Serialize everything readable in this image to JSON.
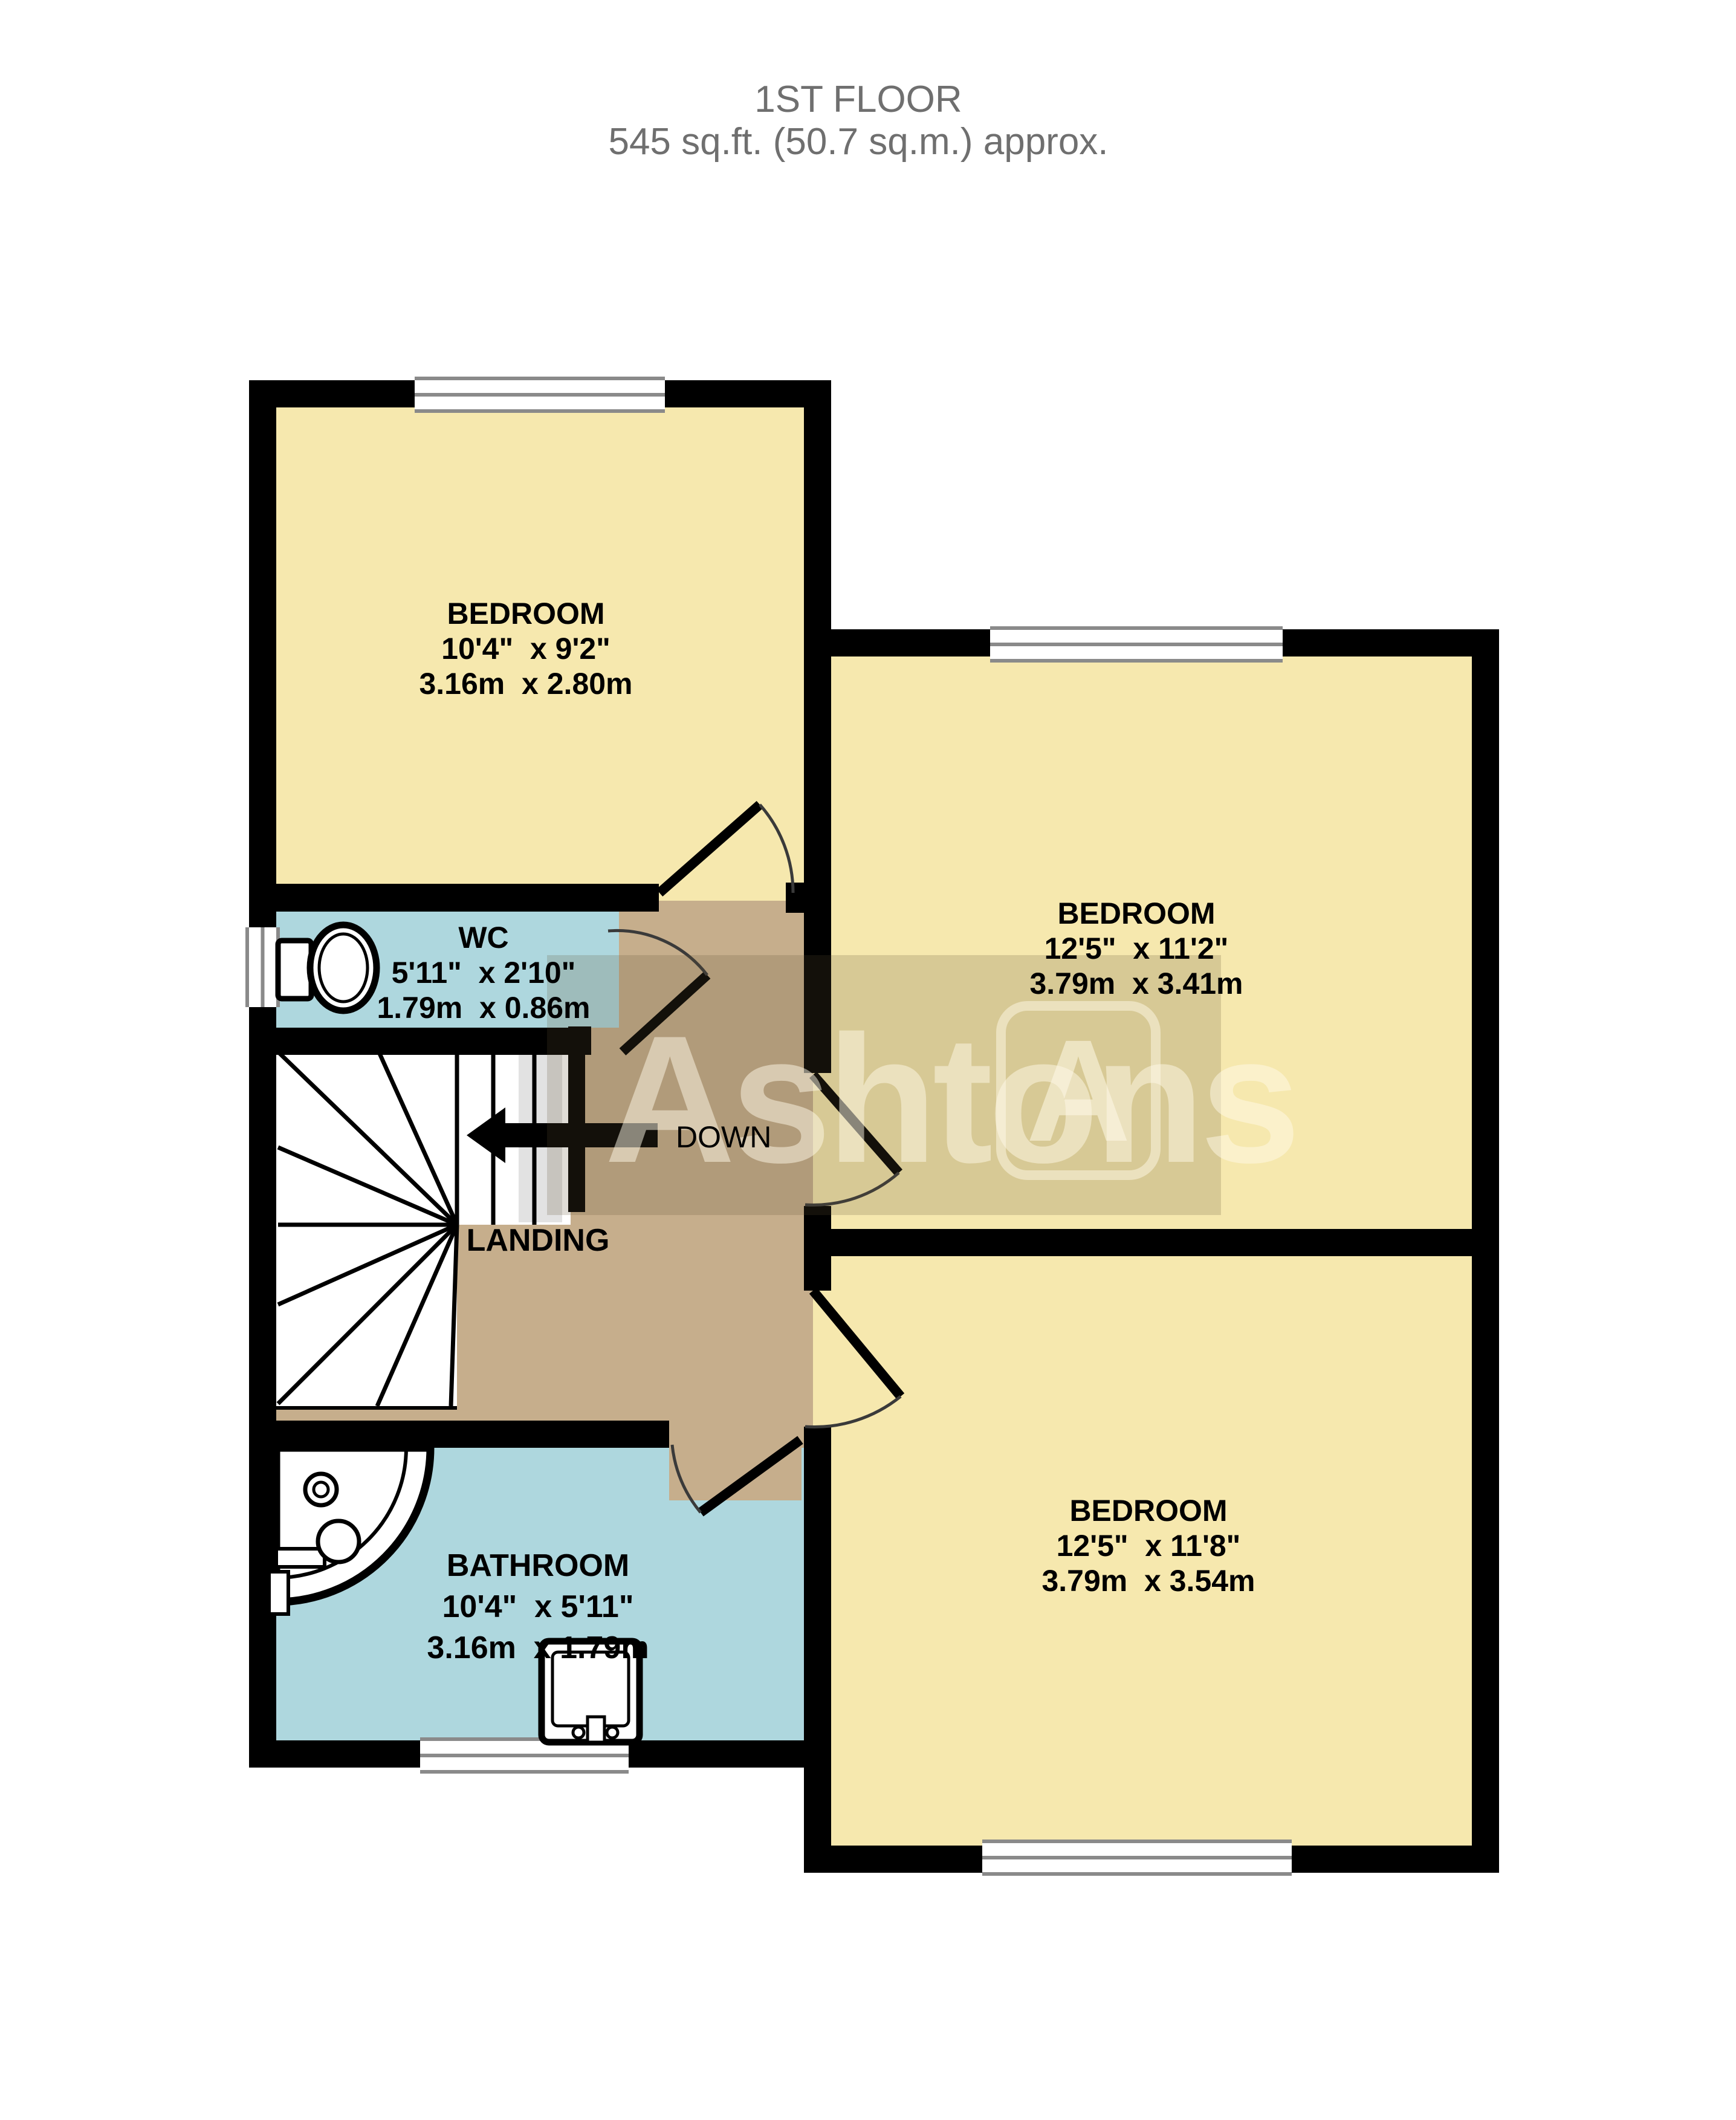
{
  "title": {
    "line1": "1ST FLOOR",
    "line2": "545 sq.ft. (50.7 sq.m.) approx."
  },
  "rooms": {
    "bedroom1": {
      "name": "BEDROOM",
      "imperial": "10'4\"  x 9'2\"",
      "metric": "3.16m  x 2.80m"
    },
    "bedroom2": {
      "name": "BEDROOM",
      "imperial": "12'5\"  x 11'2\"",
      "metric": "3.79m  x 3.41m"
    },
    "bedroom3": {
      "name": "BEDROOM",
      "imperial": "12'5\"  x 11'8\"",
      "metric": "3.79m  x 3.54m"
    },
    "wc": {
      "name": "WC",
      "imperial": "5'11\"  x 2'10\"",
      "metric": "1.79m  x 0.86m"
    },
    "bathroom": {
      "name": "BATHROOM",
      "imperial": "10'4\"  x 5'11\"",
      "metric": "3.16m  x 1.79m"
    },
    "landing": {
      "name": "LANDING"
    }
  },
  "stairs": {
    "down_label": "DOWN"
  },
  "watermark": {
    "text": "Ashtons",
    "logo_letter": "A"
  },
  "colors": {
    "bedroom_fill": "#f6e8ae",
    "wet_room_fill": "#aed7de",
    "landing_fill": "#c6ae8c",
    "wall": "#000000",
    "window_frame": "#8a8a8a",
    "title_text": "#6f6f6f",
    "watermark_overlay": "rgba(95,78,48,0.20)",
    "watermark_text": "rgba(255,250,232,0.55)"
  }
}
